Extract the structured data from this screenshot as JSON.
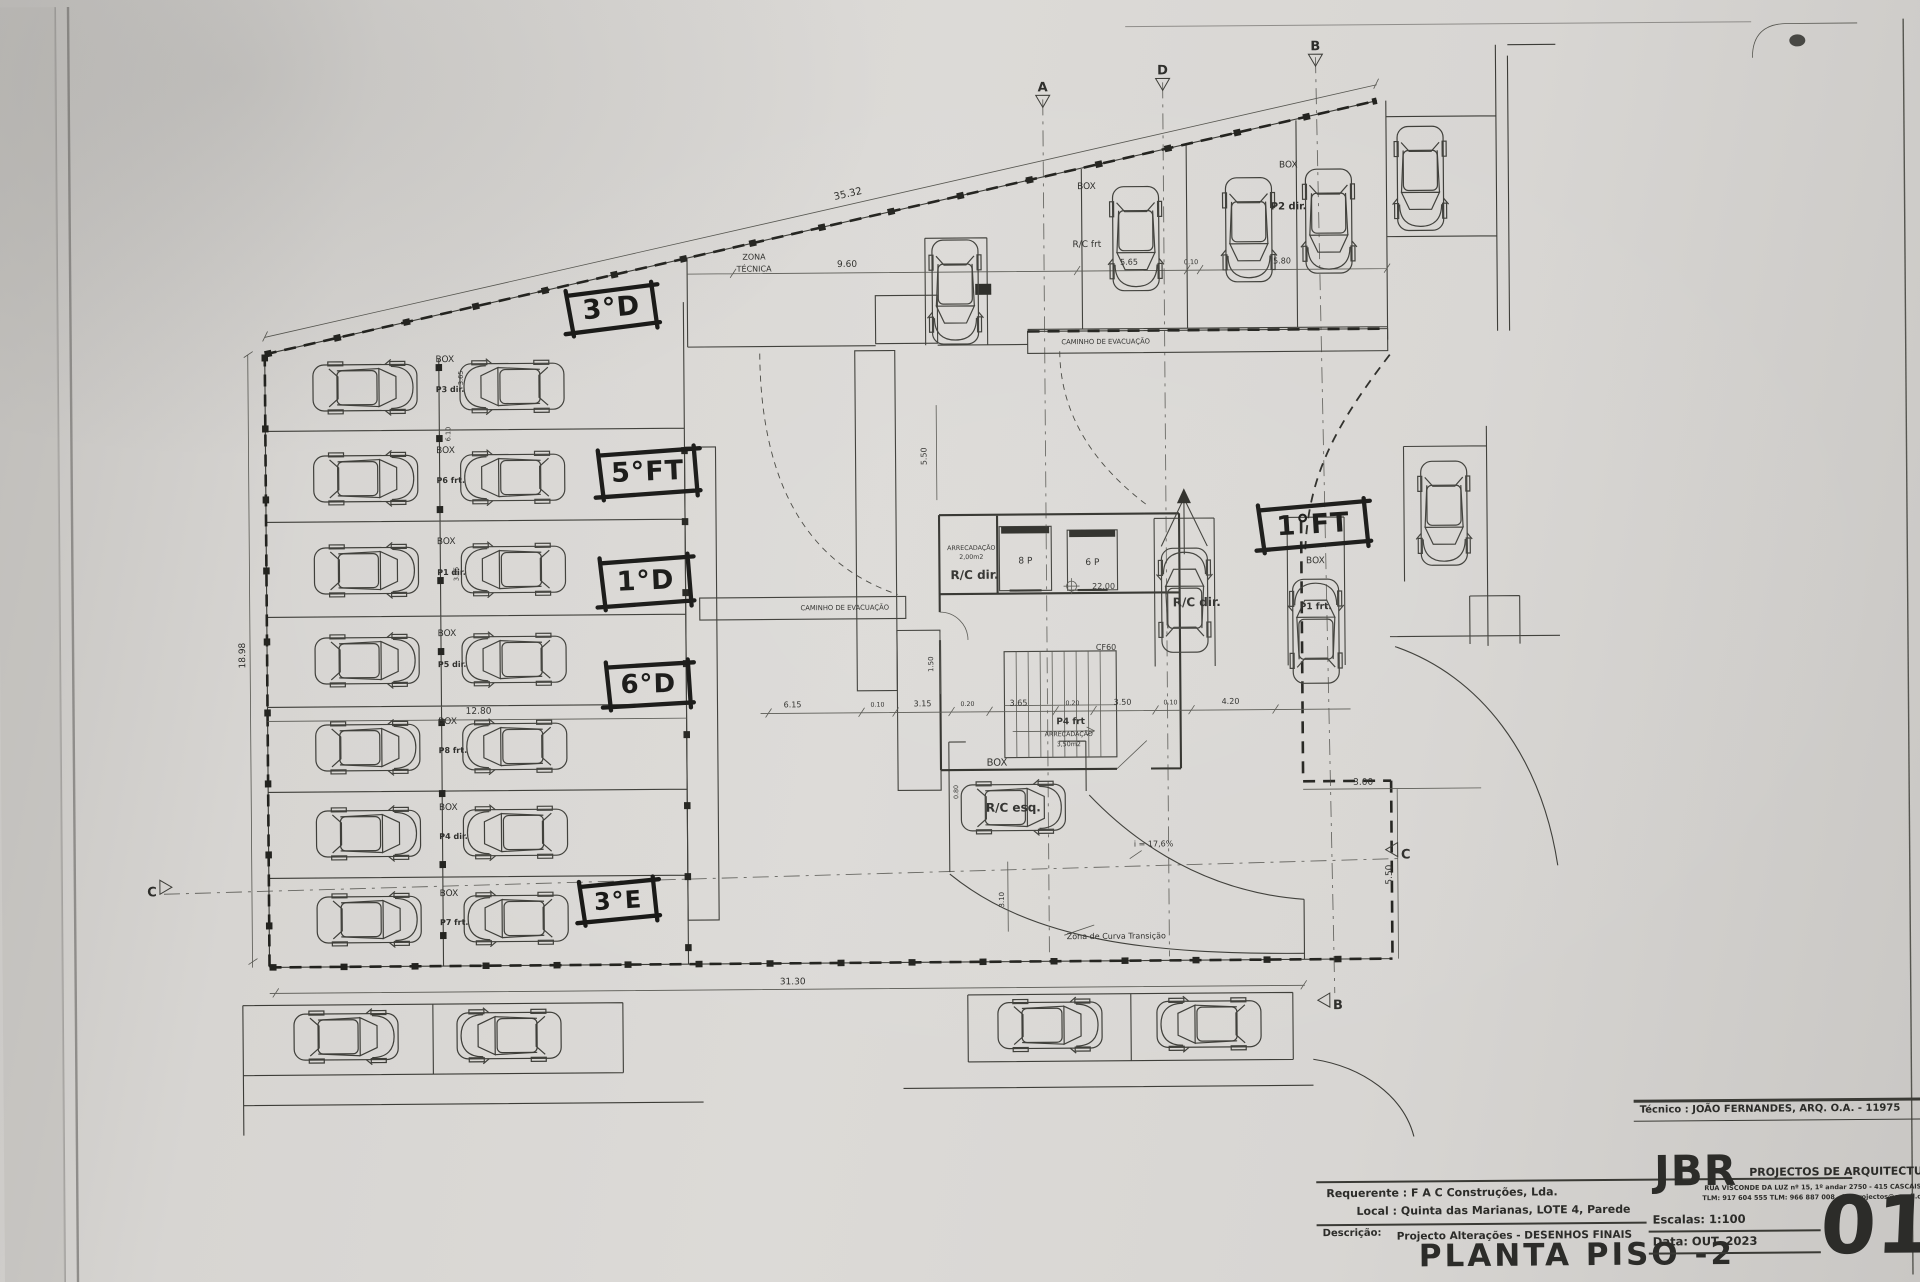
{
  "title_block": {
    "tecnico": "Técnico : JOÃO FERNANDES, ARQ.   O.A. - 11975",
    "jbr": "JBR",
    "firm": "PROJECTOS DE ARQUITECTURA",
    "address": "RUA VISCONDE DA LUZ nº 15, 1º andar   2750 - 415 CASCAIS",
    "contacts": "TLM: 917 604 555  TLM: 966 887 008  -  jbr.projectos@gmail.com",
    "requerente_label": "Requerente :",
    "requerente": "F A C  Construções, Lda.",
    "local_label": "Local :",
    "local": "Quinta das Marianas, LOTE 4, Parede",
    "descricao_label": "Descrição:",
    "descricao": "Projecto Alterações - DESENHOS FINAIS",
    "title": "PLANTA PISO -2",
    "escalas": "Escalas:  1:100",
    "data": "Data: OUT.  2023",
    "sheet": "01"
  },
  "annotations": [
    {
      "t": "3°D",
      "x": 614,
      "y": 305,
      "w": 84,
      "h": 38,
      "r": -5,
      "s": 27
    },
    {
      "t": "5°FT",
      "x": 649,
      "y": 469,
      "w": 94,
      "h": 42,
      "r": -2,
      "s": 27
    },
    {
      "t": "1°D",
      "x": 646,
      "y": 578,
      "w": 86,
      "h": 44,
      "r": -2,
      "s": 27
    },
    {
      "t": "6°D",
      "x": 648,
      "y": 681,
      "w": 80,
      "h": 40,
      "r": -1,
      "s": 26
    },
    {
      "t": "3°E",
      "x": 616,
      "y": 897,
      "w": 72,
      "h": 36,
      "r": -3,
      "s": 24
    },
    {
      "t": "1°FT",
      "x": 1314,
      "y": 527,
      "w": 104,
      "h": 40,
      "r": -3,
      "s": 27
    }
  ],
  "plan": {
    "labels": [
      {
        "t": "BOX",
        "x": 447,
        "y": 358,
        "s": 9
      },
      {
        "t": "BOX",
        "x": 447,
        "y": 449,
        "s": 9
      },
      {
        "t": "BOX",
        "x": 447,
        "y": 540,
        "s": 9
      },
      {
        "t": "BOX",
        "x": 447,
        "y": 632,
        "s": 9
      },
      {
        "t": "BOX",
        "x": 447,
        "y": 720,
        "s": 9
      },
      {
        "t": "BOX",
        "x": 447,
        "y": 806,
        "s": 9
      },
      {
        "t": "BOX",
        "x": 447,
        "y": 892,
        "s": 9
      },
      {
        "t": "P3 dir.",
        "x": 452,
        "y": 388,
        "s": 8,
        "b": 1
      },
      {
        "t": "P6 frt.",
        "x": 452,
        "y": 479,
        "s": 8,
        "b": 1
      },
      {
        "t": "P1 dir.",
        "x": 452,
        "y": 571,
        "s": 8,
        "b": 1
      },
      {
        "t": "P5 dir.",
        "x": 452,
        "y": 663,
        "s": 8,
        "b": 1
      },
      {
        "t": "P8 frt.",
        "x": 452,
        "y": 749,
        "s": 8,
        "b": 1
      },
      {
        "t": "P4 dir.",
        "x": 452,
        "y": 835,
        "s": 8,
        "b": 1
      },
      {
        "t": "P7 frt.",
        "x": 452,
        "y": 921,
        "s": 8,
        "b": 1
      },
      {
        "t": "3.65",
        "x": 465,
        "y": 374,
        "s": 6.5,
        "r": -90
      },
      {
        "t": "6.10",
        "x": 452,
        "y": 430,
        "s": 6.5,
        "r": -90
      },
      {
        "t": "3.05",
        "x": 459,
        "y": 570,
        "s": 6.5,
        "r": -90
      },
      {
        "t": "ZONA",
        "x": 757,
        "y": 258,
        "s": 8
      },
      {
        "t": "TÉCNICA",
        "x": 757,
        "y": 270,
        "s": 8
      },
      {
        "t": "9.60",
        "x": 850,
        "y": 266,
        "s": 9
      },
      {
        "t": "BOX",
        "x": 1090,
        "y": 190,
        "s": 9
      },
      {
        "t": "R/C frt",
        "x": 1090,
        "y": 248,
        "s": 9
      },
      {
        "t": "5.65",
        "x": 1132,
        "y": 266,
        "s": 8
      },
      {
        "t": "0.10",
        "x": 1194,
        "y": 266,
        "s": 6.5
      },
      {
        "t": "BOX",
        "x": 1292,
        "y": 170,
        "s": 9
      },
      {
        "t": "P2 dir.",
        "x": 1292,
        "y": 212,
        "s": 10,
        "b": 1
      },
      {
        "t": "5.80",
        "x": 1285,
        "y": 266,
        "s": 8
      },
      {
        "t": "35.32",
        "x": 852,
        "y": 196,
        "s": 10,
        "r": -12
      },
      {
        "t": "CAMINHO DE EVACUAÇÃO",
        "x": 1108,
        "y": 345,
        "s": 6.8
      },
      {
        "t": "CAMINHO DE EVACUAÇÃO",
        "x": 845,
        "y": 609,
        "s": 6.8
      },
      {
        "t": "18.98",
        "x": 245,
        "y": 650,
        "s": 9,
        "r": -90
      },
      {
        "t": "12.80",
        "x": 478,
        "y": 710,
        "s": 9
      },
      {
        "t": "5.50",
        "x": 928,
        "y": 456,
        "s": 8,
        "r": -90
      },
      {
        "t": "1.50",
        "x": 933,
        "y": 664,
        "s": 7,
        "r": -90
      },
      {
        "t": "ARRECADAÇÃO",
        "x": 972,
        "y": 550,
        "s": 6.3
      },
      {
        "t": "2,00m2",
        "x": 972,
        "y": 559,
        "s": 6.3
      },
      {
        "t": "R/C dir.",
        "x": 975,
        "y": 579,
        "s": 12,
        "b": 1
      },
      {
        "t": "8 P",
        "x": 1026,
        "y": 564,
        "s": 9
      },
      {
        "t": "6 P",
        "x": 1093,
        "y": 566,
        "s": 9
      },
      {
        "t": "22.00",
        "x": 1104,
        "y": 590,
        "s": 8
      },
      {
        "t": "CF60",
        "x": 1106,
        "y": 651,
        "s": 8
      },
      {
        "t": "R/C dir.",
        "x": 1197,
        "y": 608,
        "s": 12,
        "b": 1
      },
      {
        "t": "BOX",
        "x": 1316,
        "y": 566,
        "s": 9
      },
      {
        "t": "P1 frt.",
        "x": 1316,
        "y": 612,
        "s": 9,
        "b": 1
      },
      {
        "t": "P4 frt",
        "x": 1070,
        "y": 725,
        "s": 9,
        "b": 1
      },
      {
        "t": "ARRECADAÇÃO",
        "x": 1068,
        "y": 737,
        "s": 6.3
      },
      {
        "t": "3,50m2",
        "x": 1068,
        "y": 747,
        "s": 6.3
      },
      {
        "t": "BOX",
        "x": 996,
        "y": 766,
        "s": 10
      },
      {
        "t": "R/C esq.",
        "x": 1012,
        "y": 812,
        "s": 12,
        "b": 1
      },
      {
        "t": "6.15",
        "x": 792,
        "y": 706,
        "s": 8
      },
      {
        "t": "0.10",
        "x": 877,
        "y": 706,
        "s": 6.3
      },
      {
        "t": "3.15",
        "x": 922,
        "y": 706,
        "s": 8
      },
      {
        "t": "0.20",
        "x": 967,
        "y": 706,
        "s": 6.3
      },
      {
        "t": "3.65",
        "x": 1018,
        "y": 706,
        "s": 8
      },
      {
        "t": "0.20",
        "x": 1072,
        "y": 706,
        "s": 6.3
      },
      {
        "t": "3.50",
        "x": 1122,
        "y": 706,
        "s": 8
      },
      {
        "t": "0.10",
        "x": 1170,
        "y": 706,
        "s": 6.3
      },
      {
        "t": "4.20",
        "x": 1230,
        "y": 706,
        "s": 8
      },
      {
        "t": "31.30",
        "x": 790,
        "y": 983,
        "s": 9
      },
      {
        "t": "3.00",
        "x": 1362,
        "y": 788,
        "s": 9
      },
      {
        "t": "5.50",
        "x": 1390,
        "y": 878,
        "s": 9,
        "r": -90
      },
      {
        "t": "3.10",
        "x": 1002,
        "y": 900,
        "s": 7,
        "r": -90
      },
      {
        "t": "0.80",
        "x": 957,
        "y": 792,
        "s": 6.3,
        "r": -90
      },
      {
        "t": "i = 17,6%",
        "x": 1152,
        "y": 848,
        "s": 8
      },
      {
        "t": "Zona de Curva Transição",
        "x": 1114,
        "y": 940,
        "s": 8
      }
    ],
    "section_markers": [
      {
        "t": "A",
        "x": 1047,
        "y": 88,
        "tri": "down"
      },
      {
        "t": "D",
        "x": 1167,
        "y": 72,
        "tri": "down"
      },
      {
        "t": "B",
        "x": 1320,
        "y": 49,
        "tri": "down"
      },
      {
        "t": "C",
        "x": 150,
        "y": 886,
        "tri": "right"
      },
      {
        "t": "C",
        "x": 1404,
        "y": 858,
        "tri": "left"
      },
      {
        "t": "B",
        "x": 1335,
        "y": 1008,
        "tri": "left"
      }
    ],
    "cars": [
      {
        "x": 367,
        "y": 383,
        "r": 90
      },
      {
        "x": 514,
        "y": 383,
        "r": -90
      },
      {
        "x": 367,
        "y": 474,
        "r": 90
      },
      {
        "x": 514,
        "y": 474,
        "r": -90
      },
      {
        "x": 367,
        "y": 566,
        "r": 90
      },
      {
        "x": 514,
        "y": 566,
        "r": -90
      },
      {
        "x": 367,
        "y": 656,
        "r": 90
      },
      {
        "x": 514,
        "y": 656,
        "r": -90
      },
      {
        "x": 367,
        "y": 743,
        "r": 90
      },
      {
        "x": 514,
        "y": 743,
        "r": -90
      },
      {
        "x": 367,
        "y": 829,
        "r": 90
      },
      {
        "x": 514,
        "y": 829,
        "r": -90
      },
      {
        "x": 367,
        "y": 915,
        "r": 90
      },
      {
        "x": 514,
        "y": 915,
        "r": -90
      },
      {
        "x": 958,
        "y": 292,
        "r": 180
      },
      {
        "x": 1139,
        "y": 240,
        "r": 180
      },
      {
        "x": 1252,
        "y": 232,
        "r": 180
      },
      {
        "x": 1332,
        "y": 224,
        "r": 180
      },
      {
        "x": 1424,
        "y": 182,
        "r": 180
      },
      {
        "x": 1445,
        "y": 517,
        "r": 180
      },
      {
        "x": 1185,
        "y": 602,
        "r": 0
      },
      {
        "x": 1316,
        "y": 634,
        "r": 0
      },
      {
        "x": 1012,
        "y": 808,
        "r": 90
      },
      {
        "x": 343,
        "y": 1032,
        "r": 90
      },
      {
        "x": 506,
        "y": 1032,
        "r": -90
      },
      {
        "x": 1047,
        "y": 1026,
        "r": 90
      },
      {
        "x": 1206,
        "y": 1026,
        "r": -90
      }
    ]
  }
}
